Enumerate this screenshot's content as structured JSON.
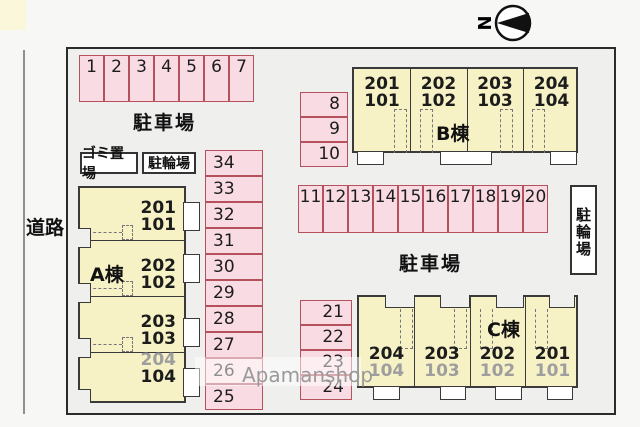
{
  "page": {
    "watermark": "Apamanshop"
  },
  "compass": {
    "north_label": "N"
  },
  "road": {
    "label": "道路"
  },
  "site": {
    "parking_label_top": "駐車場",
    "parking_label_mid": "駐車場",
    "garbage_box_label": "ゴミ置場",
    "bike_box_label_left": "駐輪場",
    "bike_box_label_right": "駐輪場",
    "parking": {
      "row_top": [
        "1",
        "2",
        "3",
        "4",
        "5",
        "6",
        "7"
      ],
      "col_890": [
        "8",
        "9",
        "10"
      ],
      "row_mid": [
        "11",
        "12",
        "13",
        "14",
        "15",
        "16",
        "17",
        "18",
        "19",
        "20"
      ],
      "col_2124": [
        "21",
        "22",
        "23",
        "24"
      ],
      "col_2534": [
        "34",
        "33",
        "32",
        "31",
        "30",
        "29",
        "28",
        "27",
        "26",
        "25"
      ]
    },
    "buildings": {
      "a": {
        "name": "A棟",
        "units": [
          {
            "upper": "201",
            "lower": "101"
          },
          {
            "upper": "202",
            "lower": "102"
          },
          {
            "upper": "203",
            "lower": "103"
          },
          {
            "upper": "204",
            "lower": "104"
          }
        ]
      },
      "b": {
        "name": "B棟",
        "units": [
          {
            "upper": "201",
            "lower": "101"
          },
          {
            "upper": "202",
            "lower": "102"
          },
          {
            "upper": "203",
            "lower": "103"
          },
          {
            "upper": "204",
            "lower": "104"
          }
        ]
      },
      "c": {
        "name": "C棟",
        "units": [
          {
            "upper": "204",
            "lower": "104"
          },
          {
            "upper": "203",
            "lower": "103"
          },
          {
            "upper": "202",
            "lower": "102"
          },
          {
            "upper": "201",
            "lower": "101"
          }
        ]
      }
    }
  }
}
